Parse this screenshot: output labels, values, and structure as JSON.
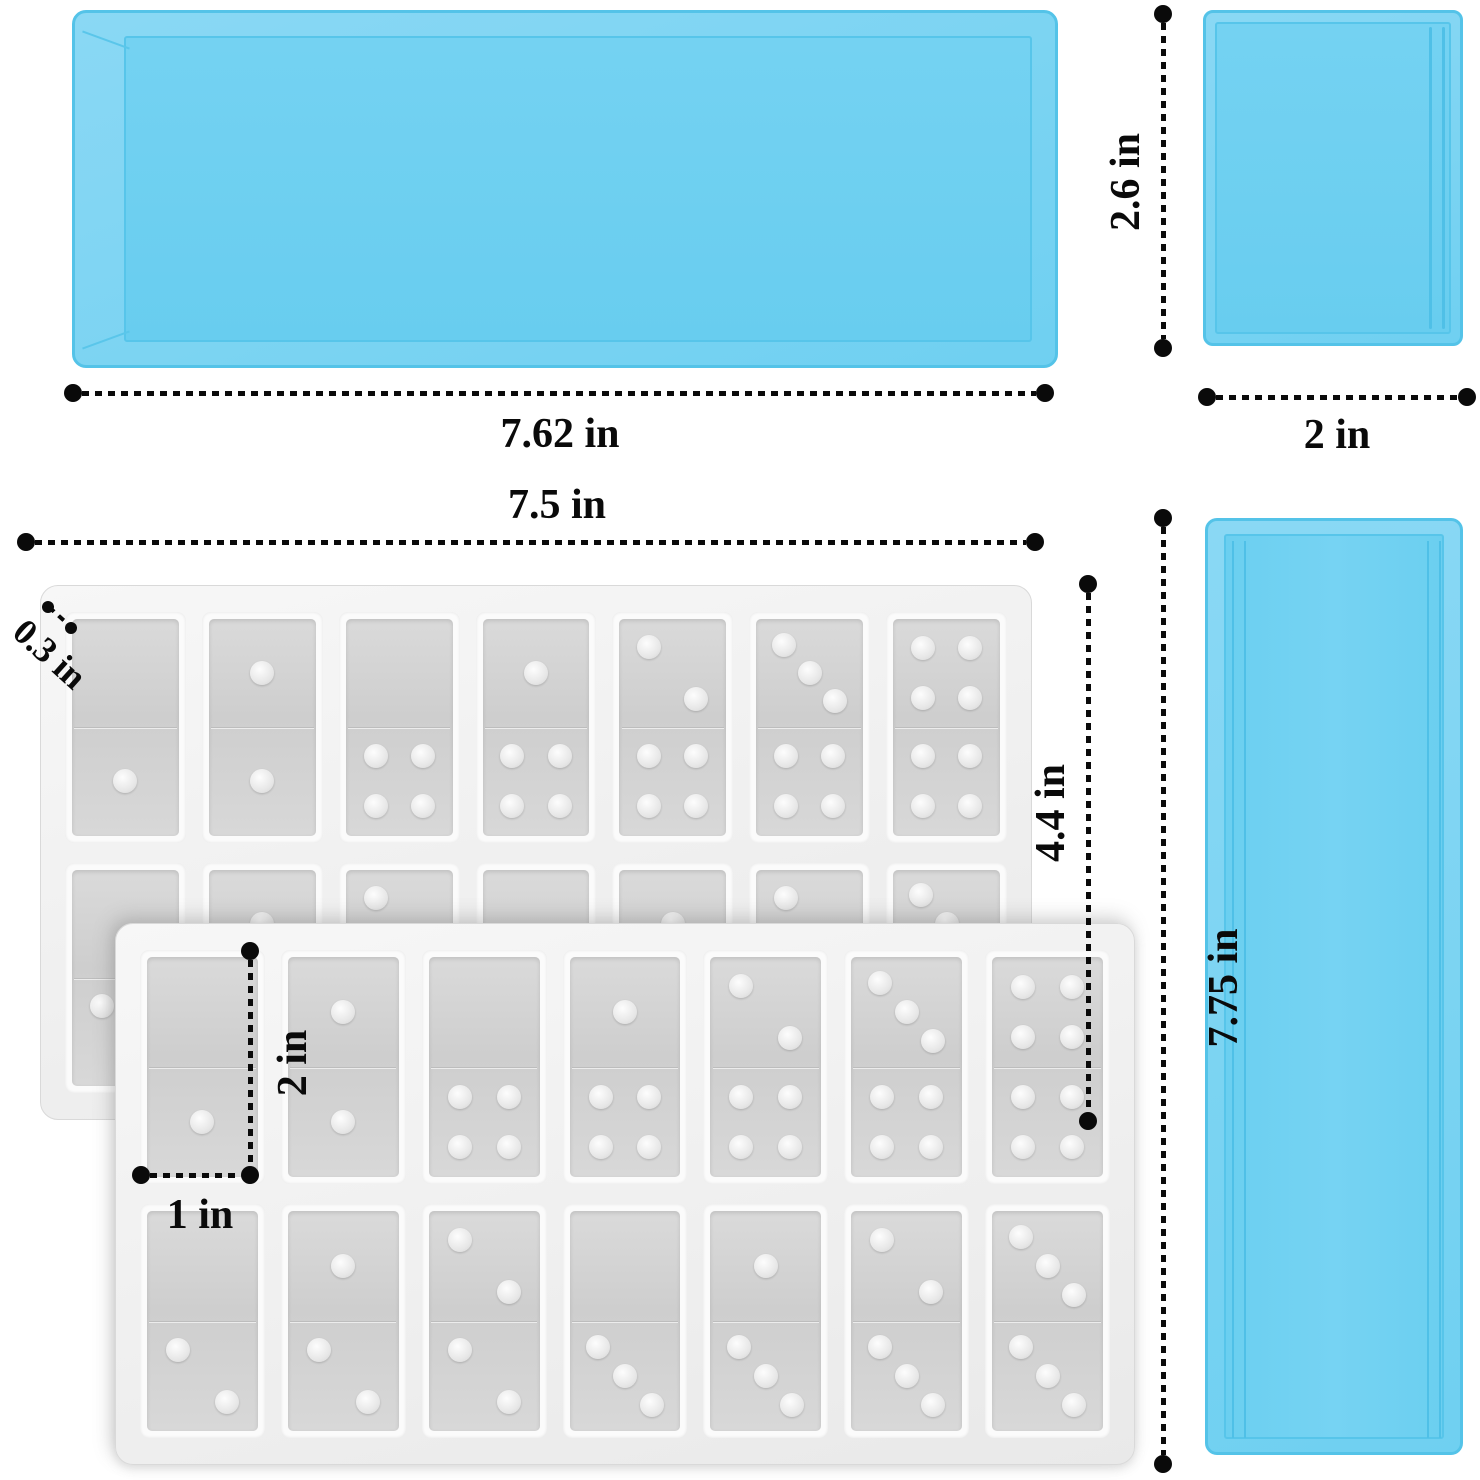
{
  "colors": {
    "tray_blue": "#7cd4f2",
    "tray_blue_edge": "#54c3e8",
    "tray_blue_floor": "#6ed0f1",
    "mold_body": "#f2f2f2",
    "mold_wall": "#fbfbfb",
    "cavity_floor": "#d4d4d4",
    "dimension_color": "#0a0a0a"
  },
  "large_tray": {
    "width_label": "7.62 in"
  },
  "small_tray": {
    "height_label": "2.6 in",
    "width_label": "2 in"
  },
  "long_tray": {
    "height_label": "7.75 in"
  },
  "domino_mold": {
    "width_label": "7.5 in",
    "height_label": "4.4 in",
    "wall_thickness_label": "0.3 in",
    "cavity_height_label": "2 in",
    "cavity_width_label": "1 in",
    "rows": 2,
    "cols": 7,
    "cavities": [
      [
        "0/1",
        "1/1",
        "0/4",
        "1/4",
        "2/4",
        "3/4",
        "4/4"
      ],
      [
        "0/2",
        "1/2",
        "2/2",
        "0/3",
        "1/3",
        "2/3",
        "3/3"
      ]
    ]
  }
}
